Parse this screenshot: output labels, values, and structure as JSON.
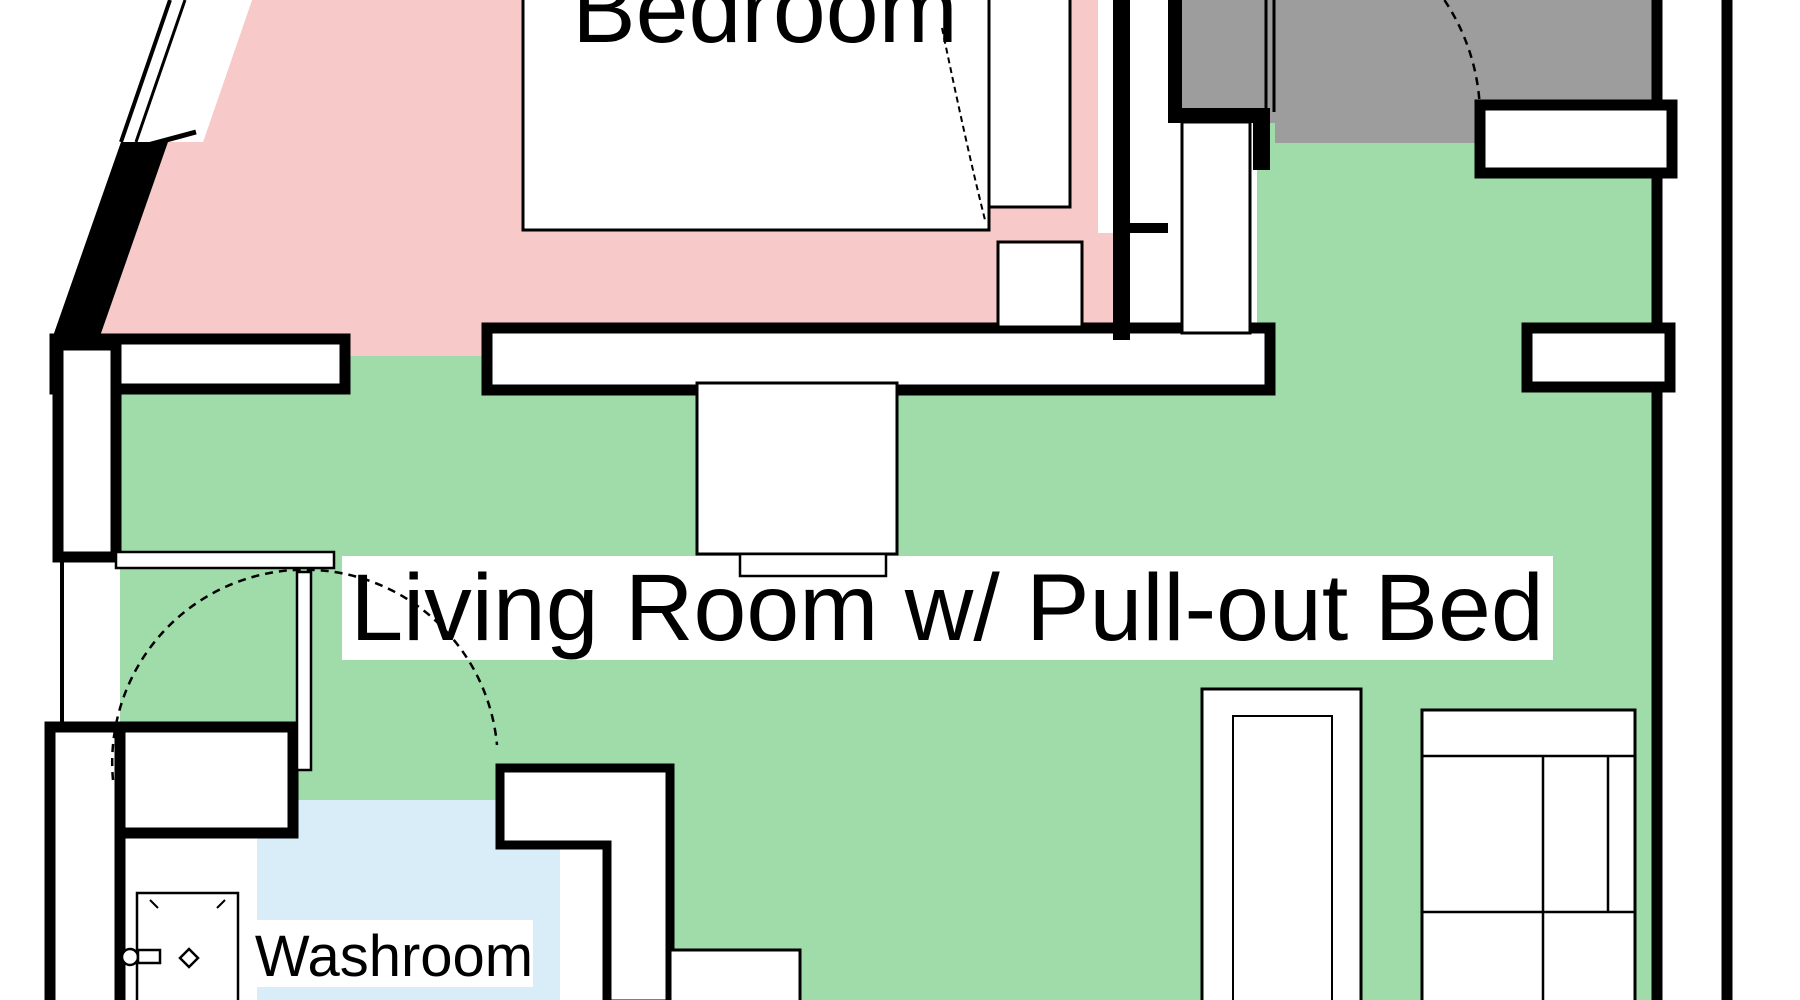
{
  "plan": {
    "rooms": {
      "bedroom": {
        "label": "Bedroom",
        "color": "#f8c9c9"
      },
      "living": {
        "label": "Living Room w/ Pull-out Bed",
        "color": "#9fdcaa"
      },
      "washroom": {
        "label": "Washroom",
        "color": "#d9edf8"
      },
      "entry": {
        "label": "",
        "color": "#9d9d9d"
      }
    },
    "colors": {
      "wall": "#000000",
      "label_background": "#ffffff",
      "furniture_fill": "#ffffff"
    }
  }
}
